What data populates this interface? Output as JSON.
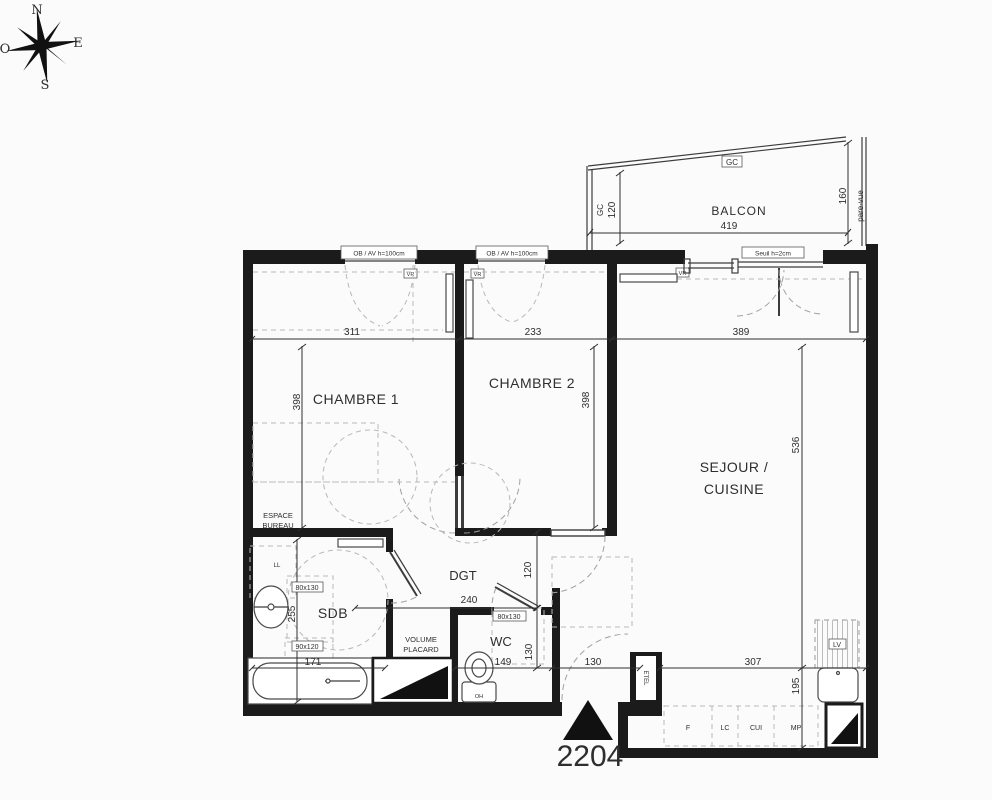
{
  "unit_number": "2204",
  "compass": {
    "north": "N",
    "south": "S",
    "east": "E",
    "west": "O"
  },
  "balcony": {
    "label": "BALCON",
    "gc_top": "GC",
    "gc_left": "GC",
    "depth_left": "120",
    "width": "419",
    "depth_right": "160",
    "screen": "pare-vue"
  },
  "openings": {
    "window_label_1": "OB / AV h=100cm",
    "window_label_2": "OB / AV h=100cm",
    "shutter_1": "VR",
    "shutter_2": "VR",
    "shutter_3": "VR",
    "threshold": "Seuil h=2cm"
  },
  "rooms": {
    "bedroom1": "CHAMBRE 1",
    "bedroom2": "CHAMBRE 2",
    "living_line1": "SEJOUR /",
    "living_line2": "CUISINE",
    "bathroom": "SDB",
    "toilet": "WC",
    "hallway": "DGT",
    "office_line1": "ESPACE",
    "office_line2": "BUREAU",
    "closet_line1": "VOLUME",
    "closet_line2": "PLACARD"
  },
  "dims": {
    "ch1_width": "311",
    "ch2_width": "233",
    "living_width": "389",
    "ch1_depth": "398",
    "ch2_depth": "398",
    "living_depth": "536",
    "bath_depth": "255",
    "bath_width": "171",
    "hall_length": "240",
    "hall_width": "120",
    "wc_width": "149",
    "wc_depth": "130",
    "entry_width": "130",
    "kitchen_width": "307",
    "kitchen_depth": "195"
  },
  "clearances": {
    "bath_a": "80x130",
    "bath_b": "90x120",
    "wc_a": "80x130"
  },
  "equipment": {
    "washing_machine": "LL",
    "dishwasher": "LV",
    "duct": "ETEL",
    "fridge": "F",
    "lc": "LC",
    "cooker": "CUI",
    "mp": "MP",
    "toilet_mark": "OH"
  }
}
